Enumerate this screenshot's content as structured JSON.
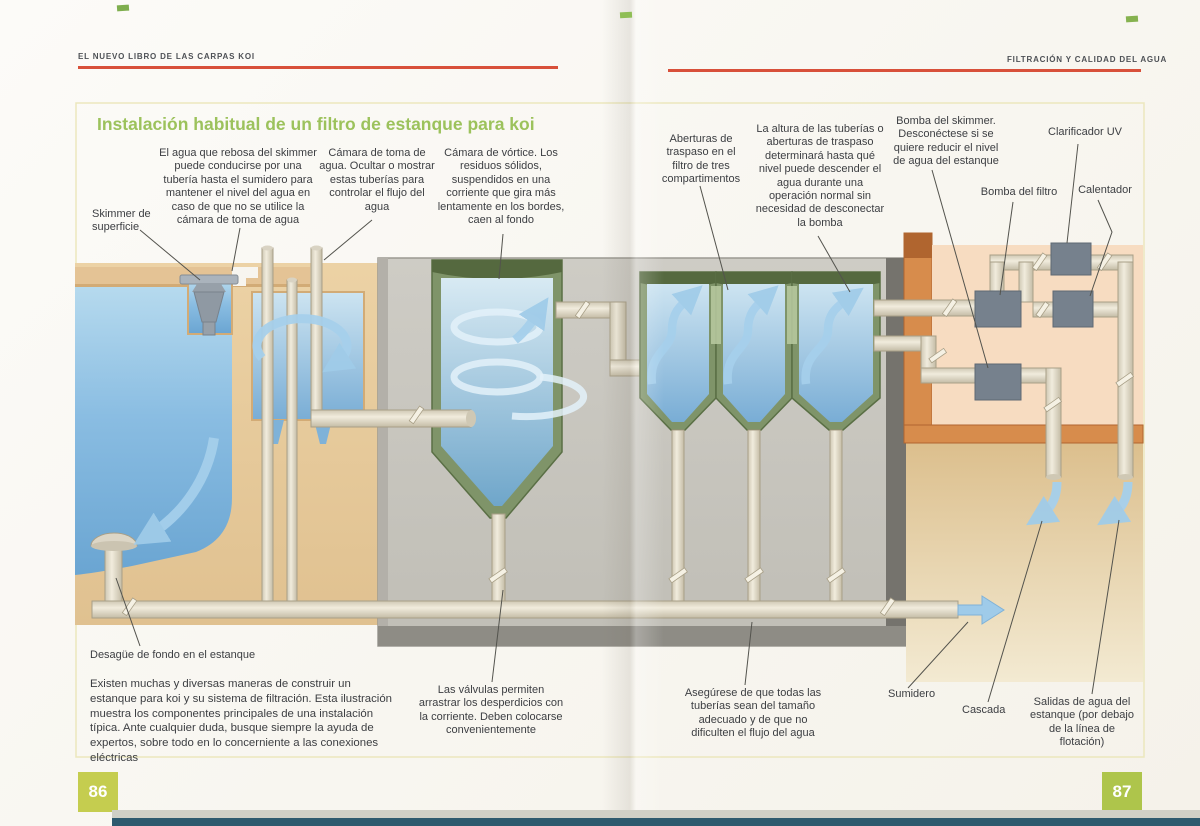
{
  "book": {
    "header_left": "EL NUEVO LIBRO DE LAS CARPAS KOI",
    "header_right": "FILTRACIÓN Y CALIDAD DEL AGUA",
    "page_left": "86",
    "page_right": "87"
  },
  "diagram": {
    "title": "Instalación habitual de un filtro de estanque para koi",
    "labels": {
      "surface_skimmer": "Skimmer de superficie",
      "overflow_pipe": "El agua que rebosa del skimmer puede conducirse por una tubería hasta el sumidero para mantener el nivel del agua en caso de que no se utilice la cámara de toma de agua",
      "intake_chamber": "Cámara de toma de agua. Ocultar o mostrar estas tuberías para controlar el flujo del agua",
      "vortex_chamber": "Cámara de vórtice. Los residuos sólidos, suspendidos en una corriente que gira más lentamente en los bordes, caen al fondo",
      "transfer_openings": "Aberturas de traspaso en el filtro de tres compartimentos",
      "pipe_height": "La altura de las tuberías o aberturas de traspaso determinará hasta qué nivel puede descender el agua durante una operación normal sin necesidad de desconectar la bomba",
      "skimmer_pump": "Bomba del skimmer. Desconéctese si se quiere reducir el nivel de agua del estanque",
      "uv_clarifier": "Clarificador UV",
      "filter_pump": "Bomba del filtro",
      "heater": "Calentador",
      "bottom_drain": "Desagüe de fondo en el estanque",
      "valves": "Las válvulas permiten arrastrar los desperdicios con la corriente. Deben colocarse convenientemente",
      "pipe_size": "Asegúrese de que todas las tuberías sean del tamaño adecuado y de que no dificulten el flujo del agua",
      "sump": "Sumidero",
      "waterfall": "Cascada",
      "pond_outlets": "Salidas de agua del estanque (por debajo de la línea de flotación)"
    },
    "footer_note": "Existen muchas y diversas maneras de construir un estanque para koi y su sistema de filtración. Esta ilustración muestra los componentes principales de una instalación típica. Ante cualquier duda, busque siempre la ayuda de expertos, sobre todo en lo concerniente a las conexiones eléctricas"
  },
  "colors": {
    "accent_red": "#d8503a",
    "title_green": "#9cc25c",
    "page_number_bg": "#b9c94e",
    "water_blue": "#7fb2d8",
    "flow_arrow_blue": "#a6d0ec",
    "pipe_cream": "#ebe5d4",
    "filter_green": "#7f9469",
    "wall_tan": "#e6c897",
    "panel_pink": "#f7dcc1",
    "equipment_gray": "#76818d"
  }
}
